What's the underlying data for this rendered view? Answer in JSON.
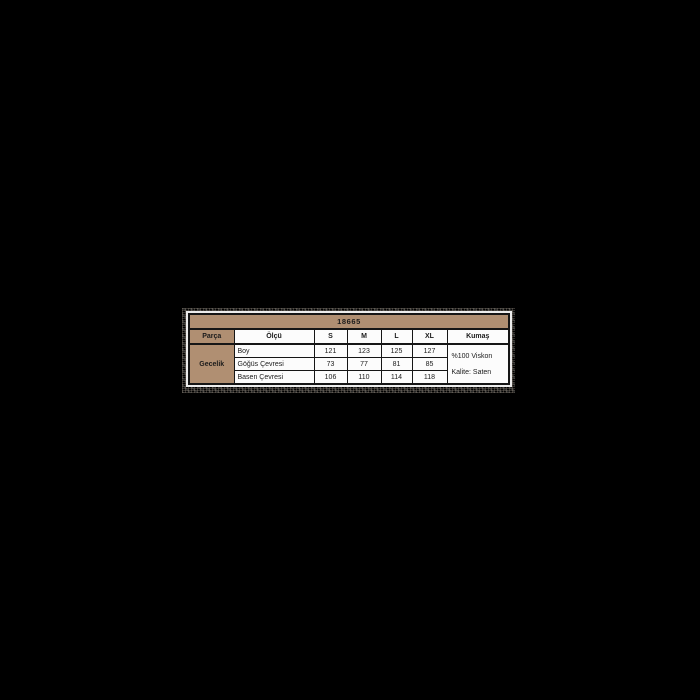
{
  "canvas": {
    "background": "#000000"
  },
  "size_chart": {
    "product_code": "18665",
    "columns": {
      "parca": "Parça",
      "olcu": "Ölçü",
      "s": "S",
      "m": "M",
      "l": "L",
      "xl": "XL",
      "kumas": "Kumaş"
    },
    "group_label": "Gecelik",
    "measurements": [
      {
        "label": "Boy",
        "values": [
          "121",
          "123",
          "125",
          "127"
        ]
      },
      {
        "label": "Göğüs Çevresi",
        "values": [
          "73",
          "77",
          "81",
          "85"
        ]
      },
      {
        "label": "Basen Çevresi",
        "values": [
          "106",
          "110",
          "114",
          "118"
        ]
      }
    ],
    "fabric": [
      "%100 Viskon",
      "Kalite: Saten"
    ],
    "colors": {
      "header_bg": "#b08f72",
      "cell_bg": "#fcfcfc",
      "border": "#161616",
      "text": "#1b1b1b",
      "page_bg": "#000000"
    }
  },
  "chart_data": {
    "type": "table",
    "title": "18665",
    "columns": [
      "Parça",
      "Ölçü",
      "S",
      "M",
      "L",
      "XL",
      "Kumaş"
    ],
    "rows": [
      [
        "Gecelik",
        "Boy",
        121,
        123,
        125,
        127,
        "%100 Viskon Kalite: Saten"
      ],
      [
        "Gecelik",
        "Göğüs Çevresi",
        73,
        77,
        81,
        85,
        "%100 Viskon Kalite: Saten"
      ],
      [
        "Gecelik",
        "Basen Çevresi",
        106,
        110,
        114,
        118,
        "%100 Viskon Kalite: Saten"
      ]
    ],
    "notes": "Size chart for nightgown (Gecelik); fabric 100% viscose, satin quality; measurements in cm"
  }
}
